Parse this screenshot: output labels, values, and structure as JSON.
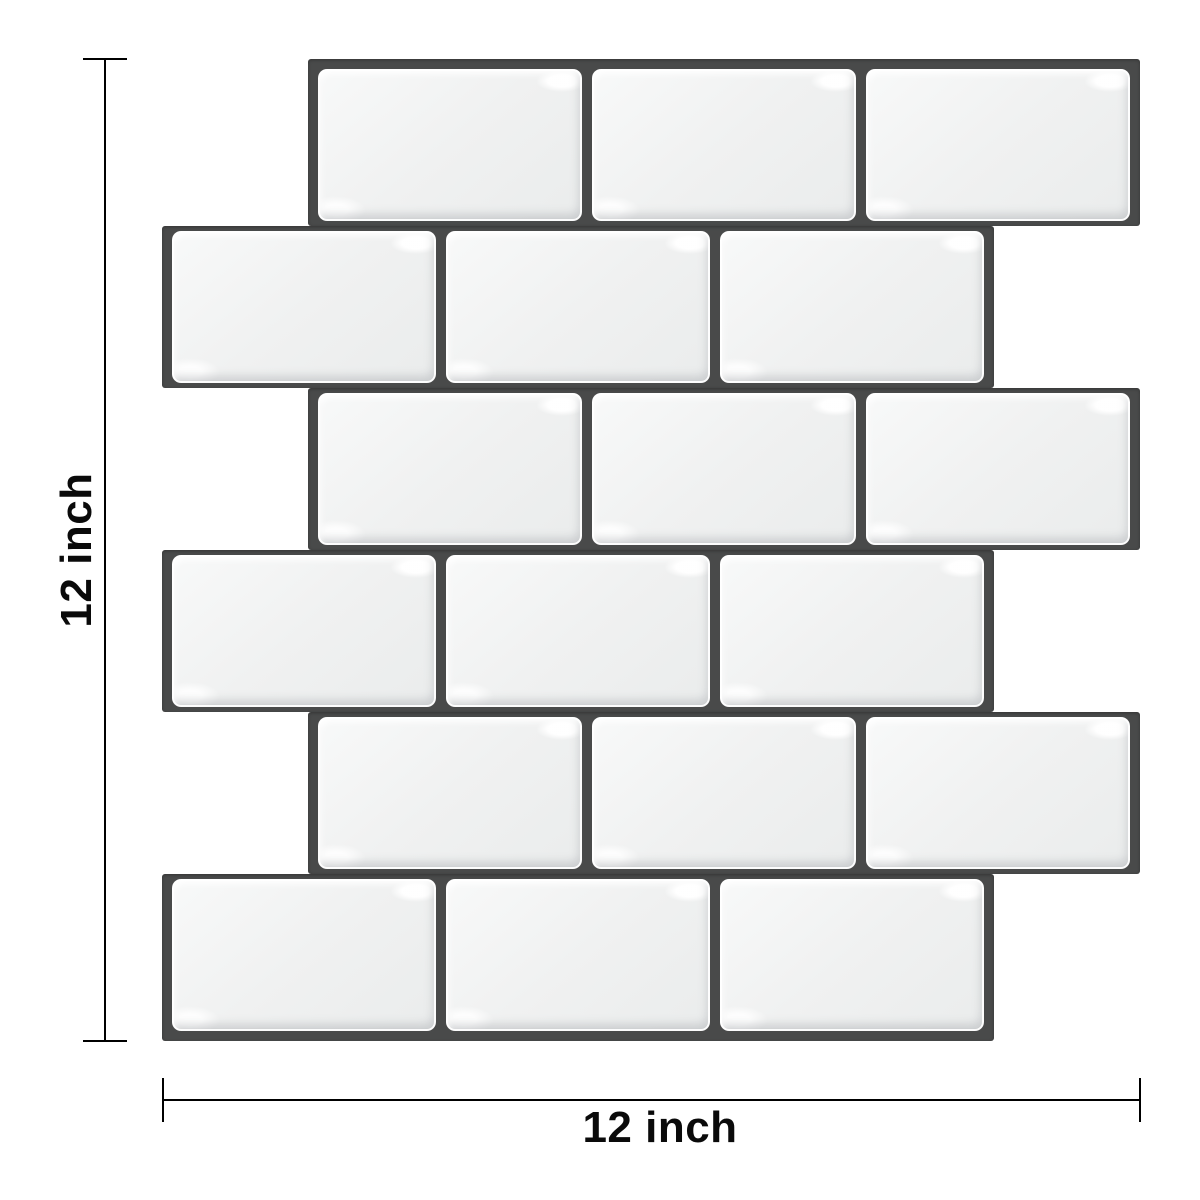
{
  "page": {
    "background": "#ffffff",
    "description_label": "peel-and-stick white subway tile sheet with dark grout, shown with size dimensions"
  },
  "colors": {
    "background": "#ffffff",
    "grout": "#494a4a",
    "tile_face": "#f0f1f1",
    "dimension_line": "#000000",
    "label_text": "#0a0a0a"
  },
  "panel": {
    "rows": [
      {
        "indented": true,
        "tile_count": 3
      },
      {
        "indented": false,
        "tile_count": 3
      },
      {
        "indented": true,
        "tile_count": 3
      },
      {
        "indented": false,
        "tile_count": 3
      },
      {
        "indented": true,
        "tile_count": 3
      },
      {
        "indented": false,
        "tile_count": 3
      }
    ]
  },
  "dimensions": {
    "height_label": "12 inch",
    "width_label": "12 inch"
  }
}
